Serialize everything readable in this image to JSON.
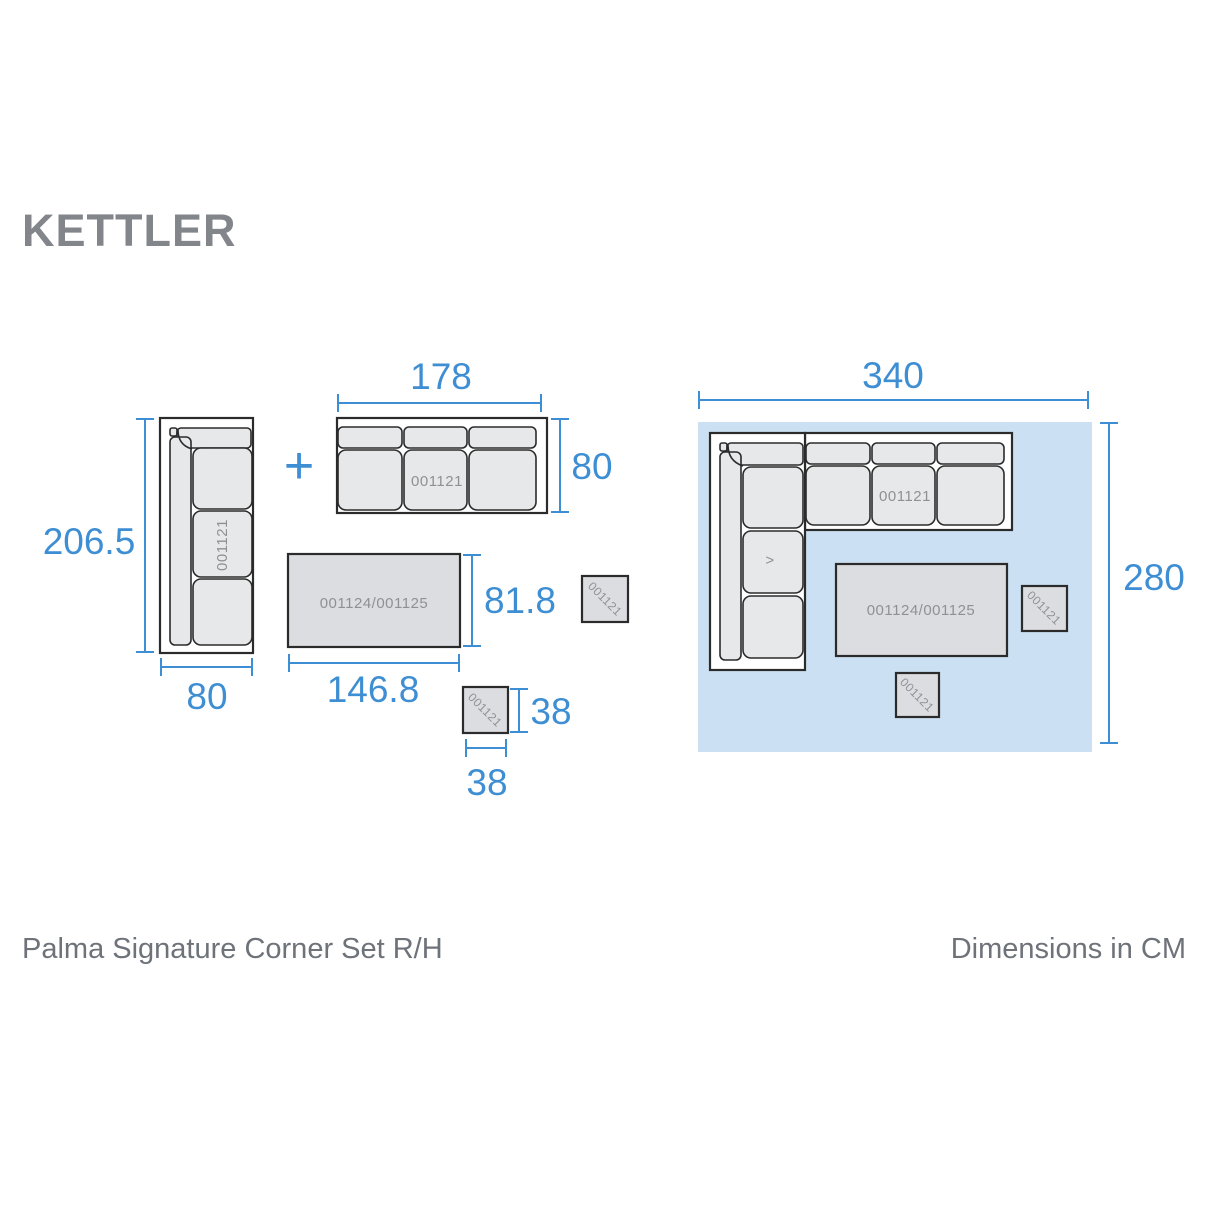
{
  "brand": "KETTLER",
  "footer": {
    "title": "Palma Signature Corner Set R/H",
    "units": "Dimensions in CM"
  },
  "icons": {
    "plus": "+"
  },
  "colors": {
    "accent_blue": "#3e8ed3",
    "highlight_background": "#cbe0f2",
    "cushion_fill": "#e7e8e9",
    "table_fill": "#dcdde0",
    "outline": "#2b2b2b",
    "label_gray": "#8e9194",
    "footer_gray": "#6e737a",
    "logo_gray": "#82868b"
  },
  "pieces": {
    "corner_sofa": {
      "id": "001121",
      "length": "206.5",
      "depth": "80"
    },
    "sofa": {
      "id": "001121",
      "length": "178",
      "depth": "80"
    },
    "table": {
      "id": "001124/001125",
      "length": "146.8",
      "width": "81.8"
    },
    "stool": {
      "id": "001121",
      "width": "38",
      "depth": "38"
    },
    "extra_stool": {
      "id": "001121"
    }
  },
  "assembled": {
    "width": "340",
    "depth": "280",
    "sofa_id": "001121",
    "corner_marker": ">",
    "table_id": "001124/001125",
    "stool_right_id": "001121",
    "stool_bottom_id": "001121"
  }
}
